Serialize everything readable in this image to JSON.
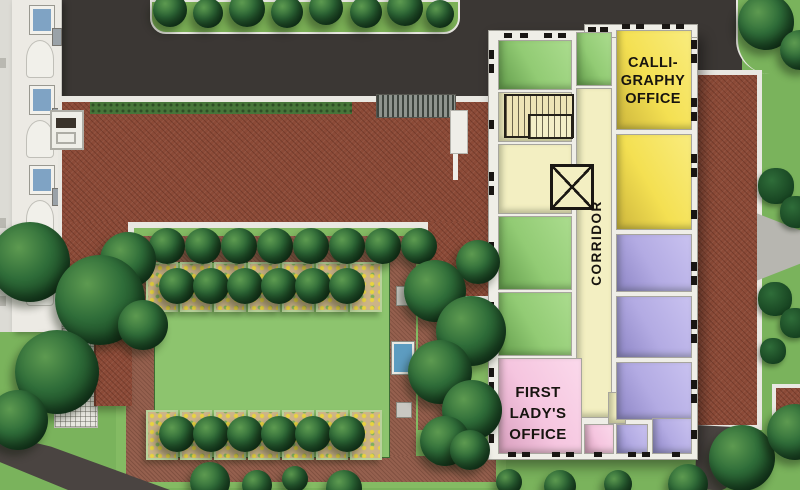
{
  "rooms": {
    "calligraphy_office": {
      "lines": [
        "CALLI-",
        "GRAPHY",
        "OFFICE"
      ]
    },
    "corridor": {
      "label": "CORRIDOR"
    },
    "first_ladys_office": {
      "lines": [
        "FIRST",
        "LADY'S",
        "OFFICE"
      ]
    }
  },
  "icons": {
    "staircase": "staircase-icon",
    "elevator": "elevator-x-icon"
  },
  "colors": {
    "lawn": "#7ab35c",
    "lawn_bright": "#8dc46e",
    "garden_lawn": "#84bb63",
    "asphalt": "#3b3734",
    "path_brick": "#95604e",
    "path_dark": "#4a4441",
    "roof_brick": "#8b4a37",
    "wall_white": "#efeee7",
    "curb_white": "#e9e8e2",
    "room_green": "#92cb74",
    "room_green_hi": "#abdc8e",
    "room_green_sh": "#639c4c",
    "room_yellow": "#f4e052",
    "room_yellow_hi": "#f9ec7e",
    "room_yellow_sh": "#cdb63c",
    "room_lavender": "#b3abe3",
    "room_lavender_hi": "#c9c2f0",
    "room_lavender_sh": "#8d85c5",
    "room_pink": "#f5c5df",
    "room_pink_hi": "#fbd9eb",
    "room_pink_sh": "#d79ebd",
    "corridor_cream": "#f3efc2",
    "tree_dark": "#15401f",
    "tree_mid": "#2f6d39",
    "tree_light": "#5d9a50",
    "hedge_green": "#47763a",
    "flowerbed_tan": "#ccb488",
    "flower_yellow": "#e8d440",
    "water_blue": "#5d9cc0",
    "walkway_gray": "#b7b6b0",
    "grate_gray": "#8f948e",
    "window_blue": "#7fa3c4",
    "ink": "#17140f"
  }
}
